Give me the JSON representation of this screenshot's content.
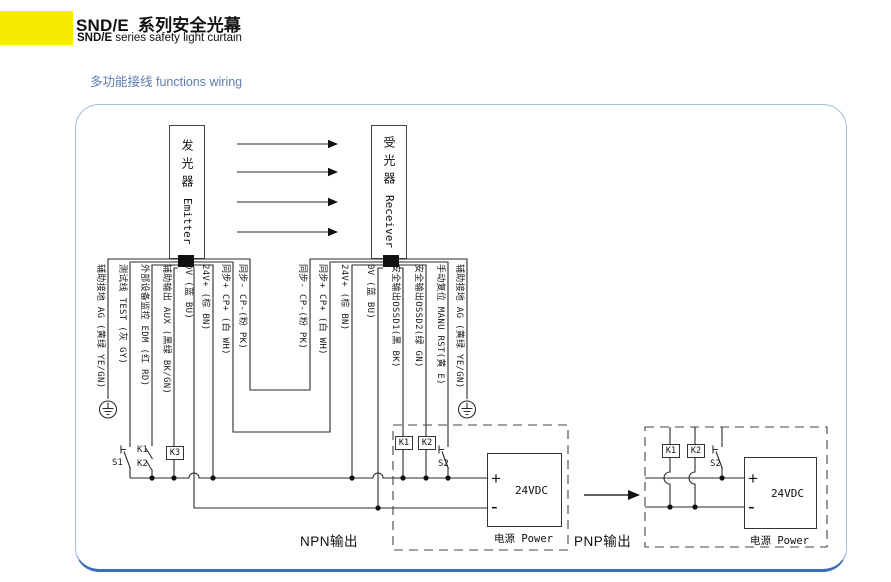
{
  "header": {
    "title_brand": "SND/E",
    "title_rest": "系列安全光幕",
    "subtitle_brand": "SND/E",
    "subtitle_rest": "series safety light curtain",
    "section_heading": "多功能接线 functions wiring",
    "accent_color": "#f7ec00",
    "heading_color": "#5e7cb2"
  },
  "diagram": {
    "emitter": {
      "cn": "发光器",
      "en": "Emitter"
    },
    "receiver": {
      "cn": "受光器",
      "en": "Receiver"
    },
    "emitter_wires": [
      "辅助接地 AG (黄绿 YE/GN)",
      "测试线 TEST (灰 GY)",
      "外部设备监控 EDM (红 RD)",
      "辅助输出 AUX (黑绿 BK/GN)",
      "0V (蓝 BU)",
      "24V+ (棕 BN)",
      "同步+ CP+ (白 WH)",
      "同步- CP-(粉 PK)"
    ],
    "receiver_wires": [
      "同步- CP-(粉 PK)",
      "同步+ CP+ (白 WH)",
      "24V+ (棕 BN)",
      "0V (蓝 BU)",
      "安全输出OSSD1(黑 BK)",
      "安全输出OSSD2(绿 GN)",
      "手动复位 MANU RST(黄 E)",
      "辅助接地 AG (黄绿 YE/GN)"
    ],
    "controls": {
      "s1": "S1",
      "k1": "K1",
      "k2": "K2",
      "k3": "K3"
    },
    "npn": {
      "output_label": "NPN输出",
      "k1": "K1",
      "k2": "K2",
      "s2": "S2",
      "psu_value": "24VDC",
      "psu_caption": "电源 Power",
      "plus": "+",
      "minus": "-"
    },
    "pnp": {
      "output_label": "PNP输出",
      "k1": "K1",
      "k2": "K2",
      "s2": "S2",
      "psu_value": "24VDC",
      "psu_caption": "电源 Power",
      "plus": "+",
      "minus": "-"
    }
  }
}
